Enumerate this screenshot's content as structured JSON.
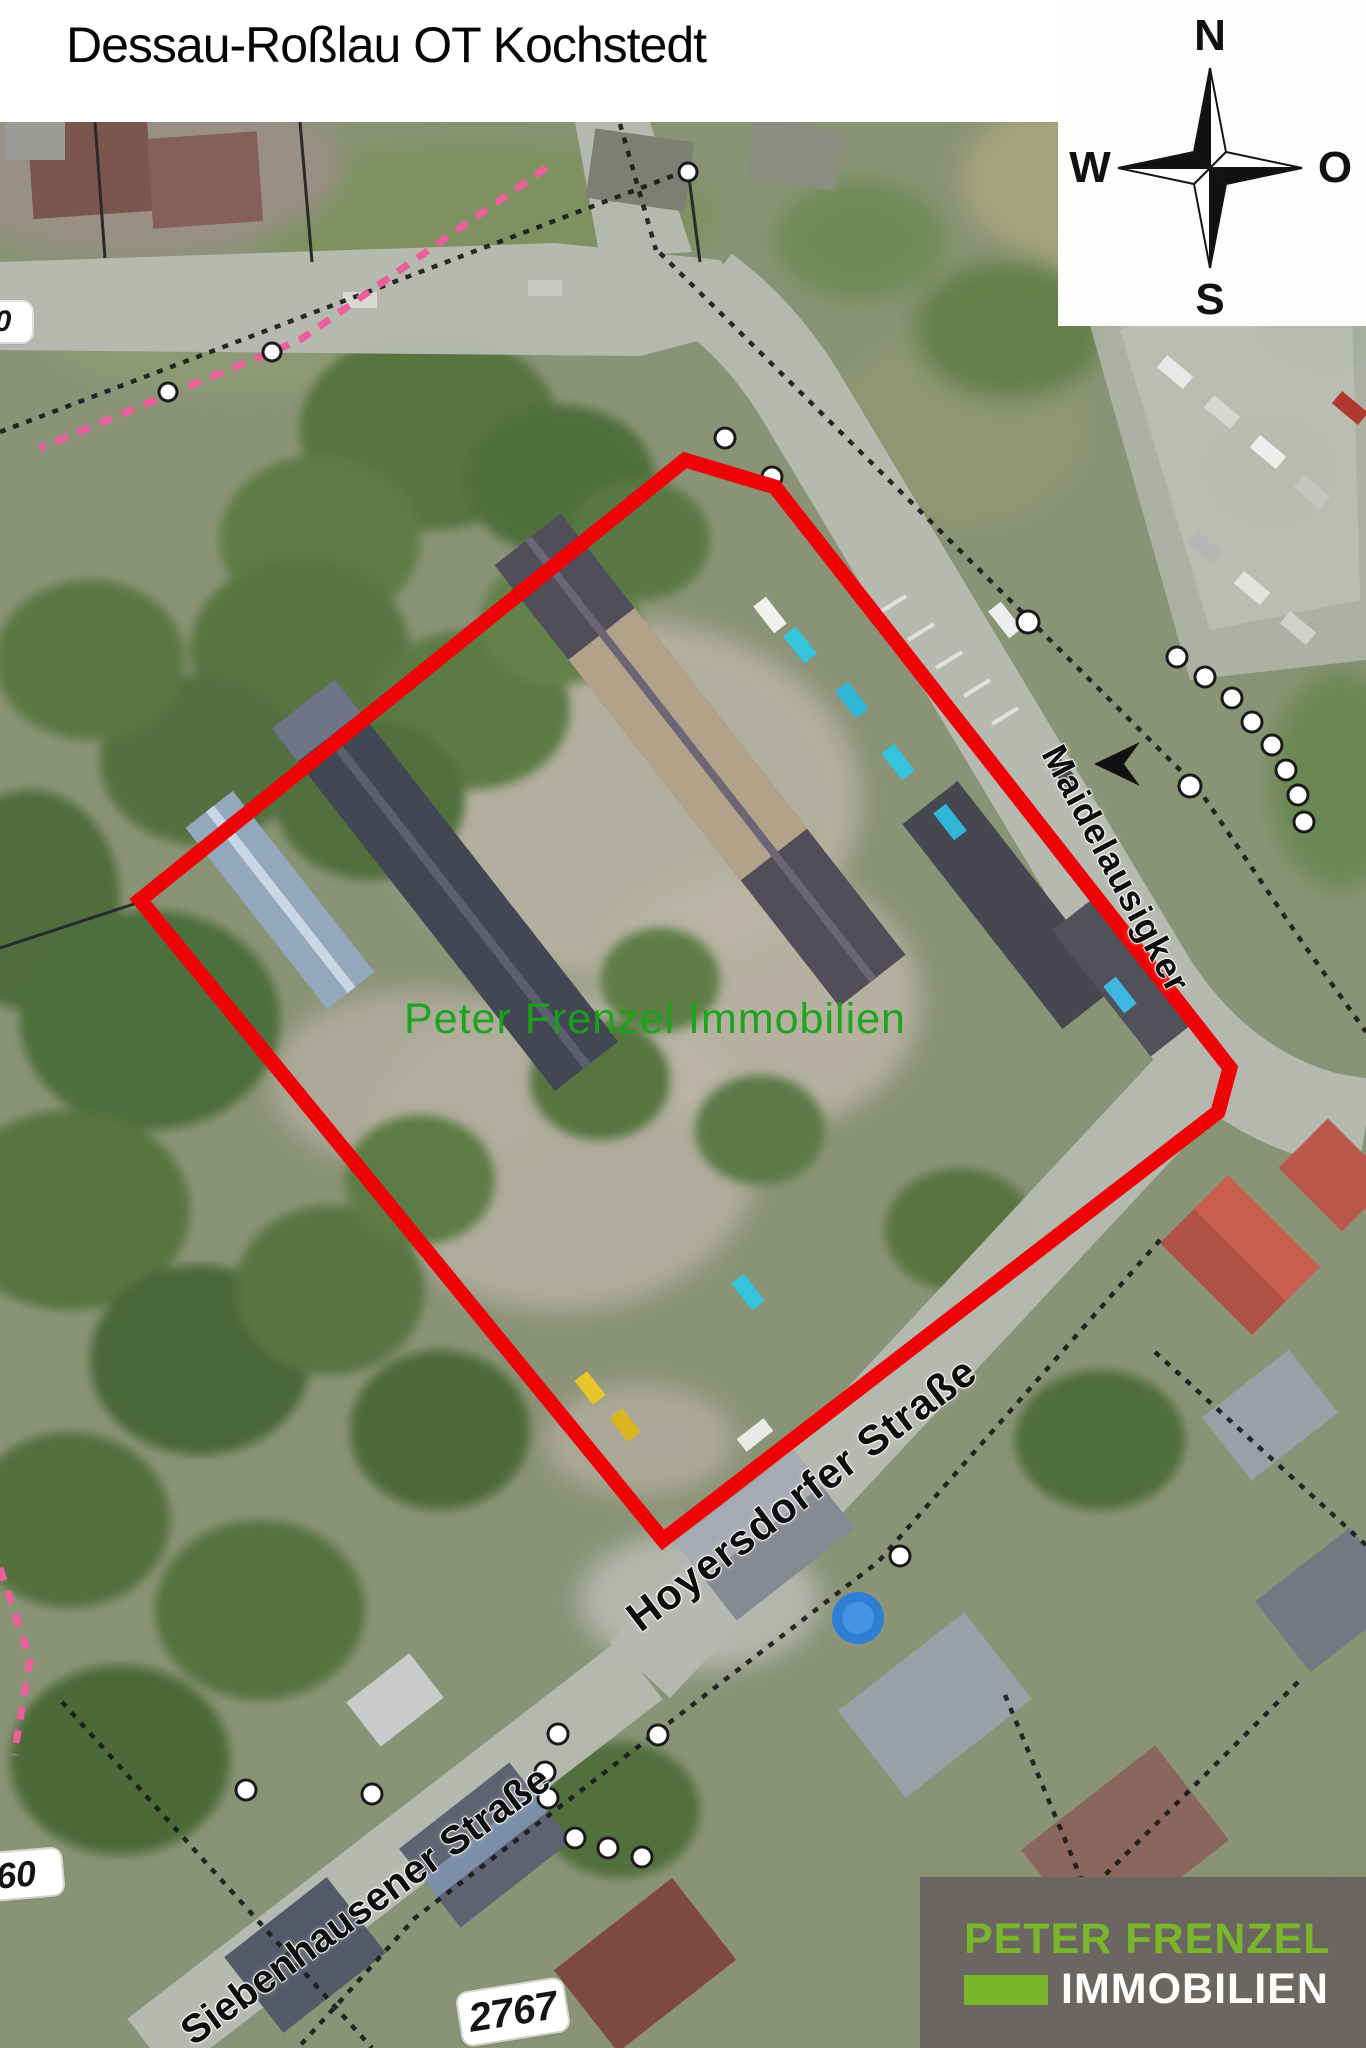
{
  "title": "Dessau-Roßlau OT Kochstedt",
  "compass": {
    "north": "N",
    "east": "O",
    "south": "S",
    "west": "W"
  },
  "map": {
    "watermark_text": "Peter Frenzel Immobilien",
    "watermark_color": "#17a519",
    "highlight_outline_color": "#ee0406",
    "boundary_dash_color": "#ec5f9d",
    "streets": [
      {
        "id": "maidelausigker",
        "name": "Maidelausigker"
      },
      {
        "id": "hoyersdorfer",
        "name": "Hoyersdorfer Straße"
      },
      {
        "id": "siebenhausener",
        "name": "Siebenhausener Straße"
      }
    ],
    "road_badges": [
      {
        "id": "main",
        "number": "2767"
      },
      {
        "id": "partial-bottom-left",
        "number": "60"
      },
      {
        "id": "partial-top-left",
        "number": "0"
      }
    ]
  },
  "logo": {
    "line1": "PETER FRENZEL",
    "line2": "IMMOBILIEN",
    "accent_color": "#7ab629",
    "background_color": "#6b6662",
    "line2_color": "#ffffff"
  }
}
